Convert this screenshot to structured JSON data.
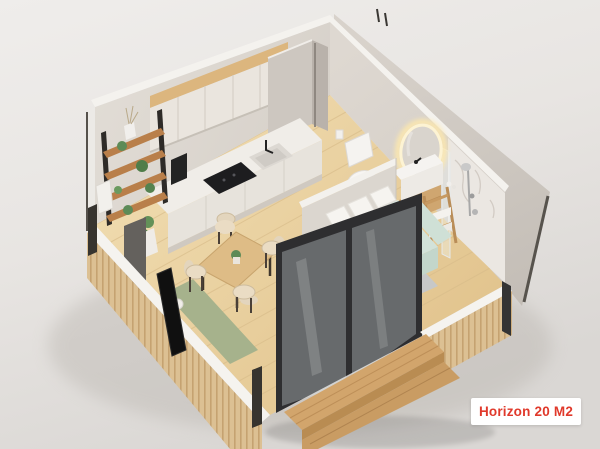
{
  "badge": {
    "label": "Horizon 20 M2"
  },
  "scene": {
    "type": "isometric-3d-floor-plan-render",
    "colors": {
      "background": "#e9e6e3",
      "walls": "#d8d2cb",
      "wall_cut_edge": "#f5f3ef",
      "floor_wood": "#ead2a4",
      "exterior_cladding": "#dcc093",
      "steps_wood": "#d2a56c",
      "door_frame": "#2e2e30",
      "sofa_mint": "#d2e2d9",
      "pillows": "#f6f4f0",
      "rug_gray": "#c3c8ce",
      "rug_green": "#a6b28c",
      "oak_furniture": "#debc86",
      "shelf_black": "#2e2b28",
      "plant_green": "#5d8b57",
      "marble": "#ebe7e2",
      "mirror_glow": "#ffe9ac",
      "label_text": "#e0392b",
      "label_bg": "#ffffff"
    },
    "rooms": [
      {
        "name": "kitchen",
        "items": [
          "upper-cabinets",
          "oak-trim",
          "countertop",
          "induction-cooktop",
          "sink-with-faucet",
          "coffee-machine",
          "base-cabinets",
          "wall-shelf-with-plants"
        ]
      },
      {
        "name": "dining-area",
        "items": [
          "square-oak-table",
          "dining-chairs-x4",
          "table-plant"
        ]
      },
      {
        "name": "living-sleeping-area",
        "items": [
          "mint-sofa-bed",
          "white-pillows",
          "throw-blanket",
          "round-coffee-table",
          "gray-area-rug",
          "green-runner-rug",
          "tv-leaning-panel",
          "floor-speaker",
          "potted-plant",
          "planter-box",
          "dark-accent-panel"
        ]
      },
      {
        "name": "bathroom",
        "items": [
          "toilet",
          "toilet-paper-holder",
          "led-ring-mirror",
          "vanity-washbasin",
          "ladder-towel-rack",
          "marble-shower-wall",
          "rain-shower-set",
          "glass-shower-screen",
          "partition-wall"
        ]
      },
      {
        "name": "exterior",
        "items": [
          "sliding-glass-door",
          "wood-slat-cladding",
          "white-slab-edge",
          "corner-posts",
          "wooden-entry-steps",
          "utility-column"
        ]
      }
    ]
  }
}
